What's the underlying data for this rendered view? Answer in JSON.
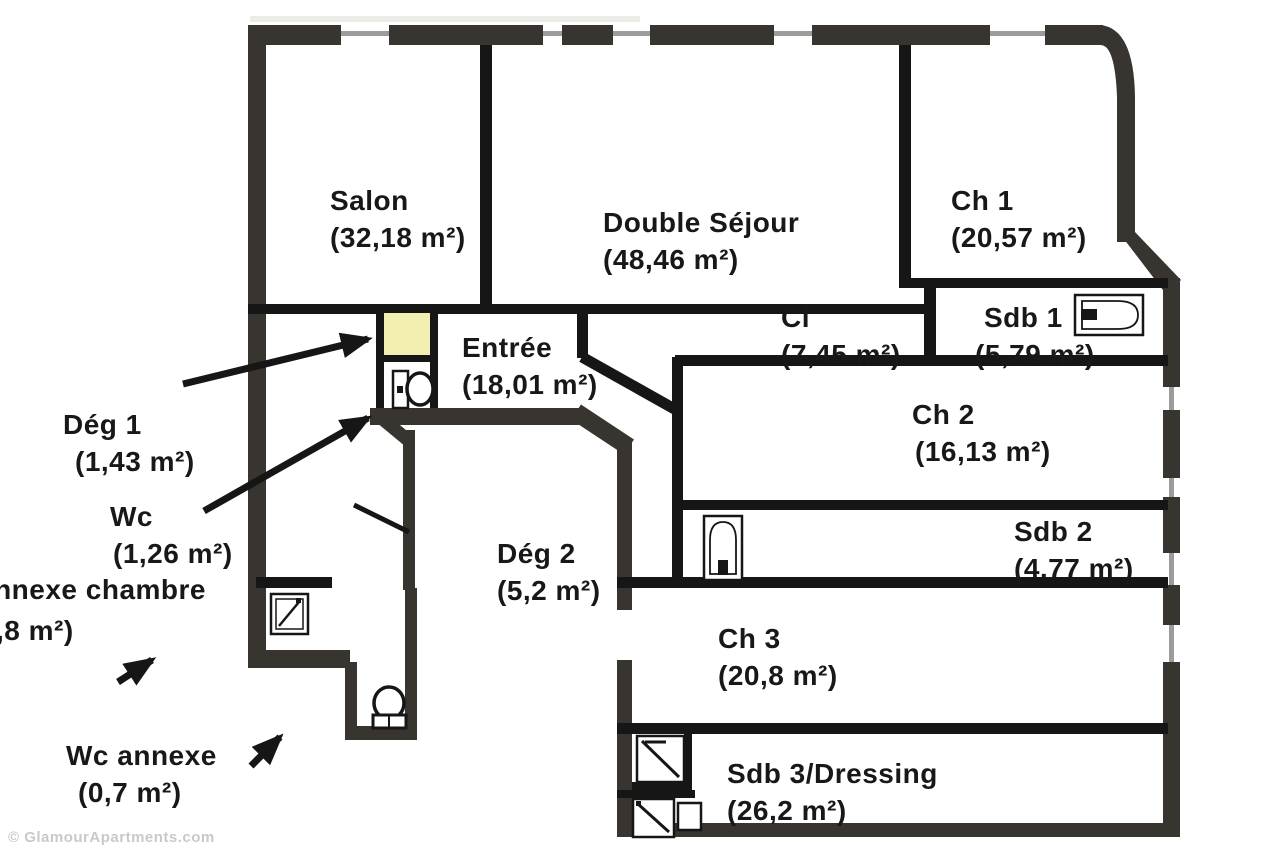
{
  "plan": {
    "title": "Apartment floor plan",
    "rooms": {
      "salon": {
        "name": "Salon",
        "area": "(32,18 m²)"
      },
      "double_sejour": {
        "name": "Double Séjour",
        "area": "(48,46 m²)"
      },
      "ch1": {
        "name": "Ch 1",
        "area": "(20,57 m²)"
      },
      "sdb1": {
        "name": "Sdb 1",
        "area": "(5,79 m²)"
      },
      "cl": {
        "name": "Cl",
        "area": "(7,45 m²)"
      },
      "entree": {
        "name": "Entrée",
        "area": "(18,01 m²)"
      },
      "ch2": {
        "name": "Ch 2",
        "area": "(16,13 m²)"
      },
      "sdb2": {
        "name": "Sdb 2",
        "area": "(4,77 m²)"
      },
      "deg2": {
        "name": "Dég 2",
        "area": "(5,2 m²)"
      },
      "ch3": {
        "name": "Ch 3",
        "area": "(20,8 m²)"
      },
      "sdb3": {
        "name": "Sdb 3/Dressing",
        "area": "(26,2 m²)"
      },
      "deg1": {
        "name": "Dég 1",
        "area": "(1,43 m²)"
      },
      "wc": {
        "name": "Wc",
        "area": "(1,26 m²)"
      },
      "annexe_chambre": {
        "name": "annexe chambre",
        "area": ",8 m²)"
      },
      "wc_annexe": {
        "name": "Wc annexe",
        "area": "(0,7 m²)"
      }
    },
    "fixtures": [
      {
        "icon": "bathtub-icon",
        "room": "Sdb 1"
      },
      {
        "icon": "bathtub-icon",
        "room": "Sdb 2"
      },
      {
        "icon": "toilet-icon",
        "room": "Wc"
      },
      {
        "icon": "toilet-icon",
        "room": "Wc annexe"
      },
      {
        "icon": "shower-icon",
        "room": "annexe chambre"
      },
      {
        "icon": "shower-icon",
        "room": "Sdb 3/Dressing"
      },
      {
        "icon": "shower-icon",
        "room": "Sdb 3/Dressing"
      }
    ],
    "annotations": {
      "arrows": [
        {
          "from_label": "Dég 1",
          "points_to": "yellow highlighted closet"
        },
        {
          "from_label": "Wc",
          "points_to": "small toilet room"
        },
        {
          "from_label": "annexe chambre",
          "points_to": "room with shower"
        },
        {
          "from_label": "Wc annexe",
          "points_to": "protruding toilet room"
        }
      ]
    },
    "colors": {
      "outer_wall": "#383430",
      "inner_wall": "#161616",
      "highlight_yellow": "#f3eeb2",
      "window_line": "#9c9c9a",
      "watermark": "#c9c9c6"
    },
    "watermark": "© GlamourApartments.com"
  }
}
